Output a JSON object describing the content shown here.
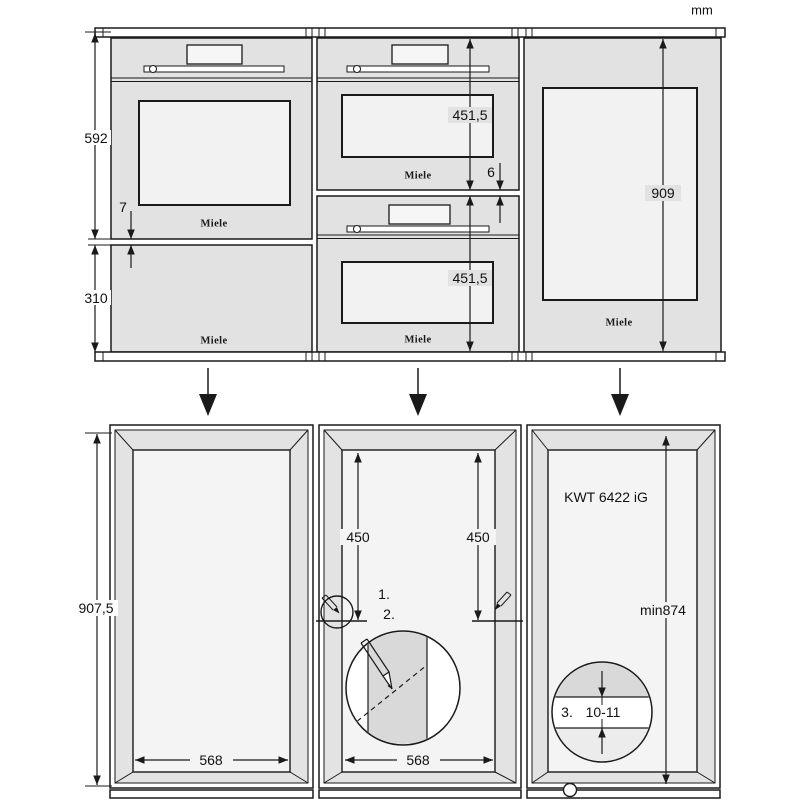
{
  "unit_label": "mm",
  "brand_logo": "Miele",
  "top_row": {
    "oven": {
      "height_dim": "592",
      "recess_dim": "7",
      "drawer_height_dim": "310"
    },
    "compacts": {
      "upper_height_dim": "451,5",
      "gap_dim": "6",
      "lower_height_dim": "451,5"
    },
    "wine_unit": {
      "height_dim": "909"
    }
  },
  "bottom_row": {
    "left_niche": {
      "height_dim": "907,5",
      "width_dim": "568"
    },
    "middle_niche": {
      "mark_left_dim": "450",
      "mark_right_dim": "450",
      "width_dim": "568",
      "step_1": "1.",
      "step_2": "2."
    },
    "right_niche": {
      "model": "KWT 6422 iG",
      "min_height_dim": "min874",
      "step_3": "3.",
      "plinth_gap_dim": "10-11"
    }
  },
  "colors": {
    "line": "#1a1a1a",
    "appliance_body": "#e2e2e2",
    "glass": "#f2f2f2",
    "niche_frame": "#e3e3e3",
    "niche_back": "#f4f4f4",
    "detail_gray": "#d9d9d9"
  }
}
